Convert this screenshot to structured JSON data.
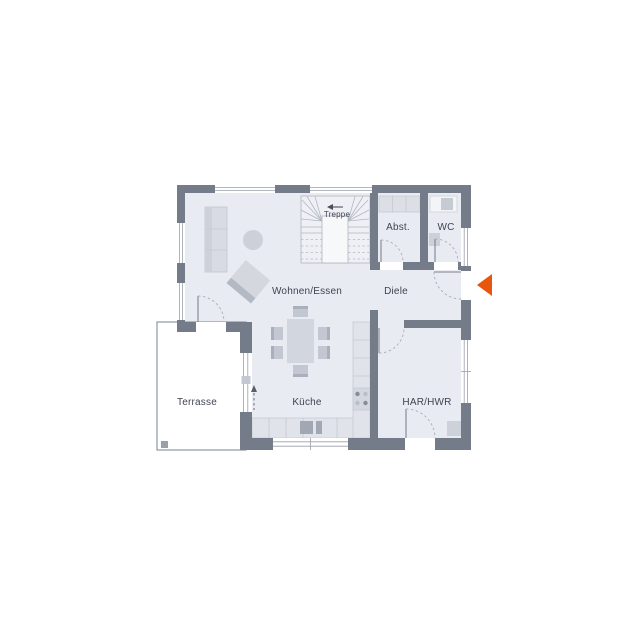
{
  "floor_plan": {
    "rooms": [
      {
        "id": "wohnen-essen",
        "label": "Wohnen/Essen"
      },
      {
        "id": "kueche",
        "label": "Küche"
      },
      {
        "id": "diele",
        "label": "Diele"
      },
      {
        "id": "treppe",
        "label": "Treppe"
      },
      {
        "id": "abstellraum",
        "label": "Abst."
      },
      {
        "id": "wc",
        "label": "WC"
      },
      {
        "id": "har-hwr",
        "label": "HAR/HWR"
      },
      {
        "id": "terrasse",
        "label": "Terrasse"
      }
    ],
    "markers": {
      "entrance_arrow": "main-entrance-direction",
      "stair_arrow": "stair-up-direction",
      "terrace_door_arrow": "sliding-door-direction"
    },
    "colors": {
      "background": "#FFFFFF",
      "wall": "#747C8A",
      "floor": "#E9EBF2",
      "furniture": "#D6D9E0",
      "outline": "#9AA0AB",
      "label_text": "#3E4450",
      "entrance_marker": "#E8550F"
    }
  }
}
